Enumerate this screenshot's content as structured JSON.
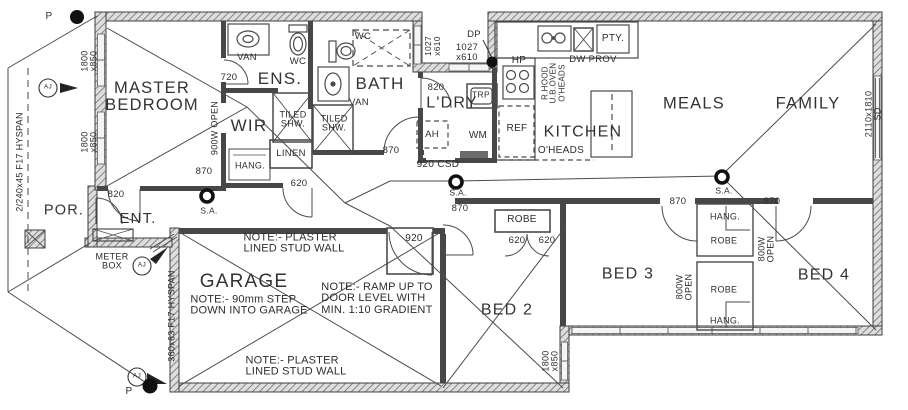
{
  "drawing": {
    "type": "residential floor plan",
    "title": "house floor plan"
  },
  "colors": {
    "wall": "#3f3f3f",
    "interior_wall": "#474747",
    "line": "#4b4b4b",
    "hatch_bg": "#dedede",
    "window": "#f2f2f2",
    "text": "#2d2d2d",
    "paper": "#ffffff"
  },
  "labels": [
    {
      "name": "room-master-bedroom",
      "cat": "room",
      "text": "MASTER\nBEDROOM",
      "x": 152,
      "y": 97,
      "fs": 16.5,
      "cls": "room"
    },
    {
      "name": "room-ens",
      "cat": "room",
      "text": "ENS.",
      "x": 280,
      "y": 79,
      "fs": 17,
      "cls": "room"
    },
    {
      "name": "room-wir",
      "cat": "room",
      "text": "WIR",
      "x": 249,
      "y": 126,
      "fs": 17,
      "cls": "room"
    },
    {
      "name": "room-bath",
      "cat": "room",
      "text": "BATH",
      "x": 380,
      "y": 84,
      "fs": 17,
      "cls": "room"
    },
    {
      "name": "room-ldry",
      "cat": "room",
      "text": "L'DRY",
      "x": 452,
      "y": 104,
      "fs": 16,
      "cls": "room"
    },
    {
      "name": "room-kitchen",
      "cat": "room",
      "text": "KITCHEN",
      "x": 583,
      "y": 133,
      "fs": 16,
      "cls": "room"
    },
    {
      "name": "room-meals",
      "cat": "room",
      "text": "MEALS",
      "x": 694,
      "y": 104,
      "fs": 16.5,
      "cls": "room"
    },
    {
      "name": "room-family",
      "cat": "room",
      "text": "FAMILY",
      "x": 808,
      "y": 104,
      "fs": 16.5,
      "cls": "room"
    },
    {
      "name": "room-por",
      "cat": "room",
      "text": "POR.",
      "x": 64,
      "y": 211,
      "fs": 14.5,
      "cls": "room"
    },
    {
      "name": "room-ent",
      "cat": "room",
      "text": "ENT.",
      "x": 138,
      "y": 219,
      "fs": 15,
      "cls": "room"
    },
    {
      "name": "room-garage",
      "cat": "room",
      "text": "GARAGE",
      "x": 244,
      "y": 282,
      "fs": 19,
      "cls": "room"
    },
    {
      "name": "room-bed2",
      "cat": "room",
      "text": "BED 2",
      "x": 507,
      "y": 311,
      "fs": 16,
      "cls": "room"
    },
    {
      "name": "room-bed3",
      "cat": "room",
      "text": "BED 3",
      "x": 628,
      "y": 275,
      "fs": 16,
      "cls": "room"
    },
    {
      "name": "room-bed4",
      "cat": "room",
      "text": "BED 4",
      "x": 824,
      "y": 276,
      "fs": 16,
      "cls": "room"
    },
    {
      "name": "fixture-van-ens",
      "cat": "fixture",
      "text": "VAN",
      "x": 247,
      "y": 58,
      "fs": 9.5
    },
    {
      "name": "fixture-wc-ens",
      "cat": "fixture",
      "text": "WC",
      "x": 298,
      "y": 62,
      "fs": 9.5
    },
    {
      "name": "fixture-wc-bath",
      "cat": "fixture",
      "text": "WC",
      "x": 363,
      "y": 37,
      "fs": 9.5
    },
    {
      "name": "fixture-van-bath",
      "cat": "fixture",
      "text": "VAN",
      "x": 359,
      "y": 103,
      "fs": 9.5
    },
    {
      "name": "fixture-tiled-shw-ens",
      "cat": "fixture",
      "text": "TILED\nSHW.",
      "x": 293,
      "y": 120,
      "fs": 9
    },
    {
      "name": "fixture-tiled-shw-bath",
      "cat": "fixture",
      "text": "TILED\nSHW.",
      "x": 334,
      "y": 124,
      "fs": 9
    },
    {
      "name": "fixture-linen",
      "cat": "fixture",
      "text": "LINEN",
      "x": 291,
      "y": 154,
      "fs": 9.5
    },
    {
      "name": "fixture-hang-wir",
      "cat": "fixture",
      "text": "HANG.",
      "x": 250,
      "y": 166,
      "fs": 9
    },
    {
      "name": "fixture-trough",
      "cat": "fixture",
      "text": "TRP",
      "x": 481,
      "y": 95,
      "fs": 8.5
    },
    {
      "name": "fixture-ah",
      "cat": "fixture",
      "text": "AH",
      "x": 432,
      "y": 135,
      "fs": 9.5
    },
    {
      "name": "fixture-wm",
      "cat": "fixture",
      "text": "WM",
      "x": 478,
      "y": 136,
      "fs": 10
    },
    {
      "name": "fixture-ref",
      "cat": "fixture",
      "text": "REF",
      "x": 517,
      "y": 129,
      "fs": 10
    },
    {
      "name": "fixture-hp",
      "cat": "fixture",
      "text": "HP",
      "x": 519,
      "y": 61,
      "fs": 10
    },
    {
      "name": "fixture-rangehood",
      "cat": "fixture",
      "text": "R.HOOD\nU.B.OVEN\nO'HEADS",
      "x": 554,
      "y": 83,
      "fs": 8,
      "rot": true
    },
    {
      "name": "fixture-dw-prov",
      "cat": "fixture",
      "text": "DW PROV",
      "x": 593,
      "y": 60,
      "fs": 9.5
    },
    {
      "name": "fixture-pty",
      "cat": "fixture",
      "text": "PTY.",
      "x": 613,
      "y": 39,
      "fs": 10
    },
    {
      "name": "fixture-oheads-kitchen",
      "cat": "fixture",
      "text": "O'HEADS",
      "x": 561,
      "y": 151,
      "fs": 10
    },
    {
      "name": "fixture-meter-box",
      "cat": "fixture",
      "text": "METER\nBOX",
      "x": 112,
      "y": 262,
      "fs": 9
    },
    {
      "name": "fixture-robe-hall",
      "cat": "fixture",
      "text": "ROBE",
      "x": 522,
      "y": 220,
      "fs": 10
    },
    {
      "name": "fixture-hang-robe-top",
      "cat": "fixture",
      "text": "HANG.",
      "x": 725,
      "y": 217,
      "fs": 9
    },
    {
      "name": "fixture-robe-top",
      "cat": "fixture",
      "text": "ROBE",
      "x": 724,
      "y": 241,
      "fs": 9
    },
    {
      "name": "fixture-robe-bottom",
      "cat": "fixture",
      "text": "ROBE",
      "x": 724,
      "y": 290,
      "fs": 9
    },
    {
      "name": "fixture-hang-robe-bottom",
      "cat": "fixture",
      "text": "HANG.",
      "x": 725,
      "y": 321,
      "fs": 9
    },
    {
      "name": "dim-720-ens-door",
      "cat": "dimension",
      "text": "720",
      "x": 229,
      "y": 78,
      "fs": 9.5
    },
    {
      "name": "dim-820-master-door",
      "cat": "dimension",
      "text": "820",
      "x": 116,
      "y": 195,
      "fs": 9.5
    },
    {
      "name": "dim-870-wir-door",
      "cat": "dimension",
      "text": "870",
      "x": 204,
      "y": 172,
      "fs": 9.5
    },
    {
      "name": "dim-900w-open",
      "cat": "dimension",
      "text": "900W OPEN",
      "x": 215,
      "y": 128,
      "fs": 9,
      "rot": true
    },
    {
      "name": "dim-window-1800x850-upper",
      "cat": "dimension",
      "text": "1800\nx850",
      "x": 90,
      "y": 61,
      "fs": 9,
      "rot": true
    },
    {
      "name": "dim-window-1800x850-lower",
      "cat": "dimension",
      "text": "1800\nx850",
      "x": 90,
      "y": 142,
      "fs": 9,
      "rot": true
    },
    {
      "name": "dim-beam-hyspan-porch",
      "cat": "dimension",
      "text": "2/240x45 F17 HYSPAN",
      "x": 20,
      "y": 162,
      "fs": 9,
      "rot": true
    },
    {
      "name": "dim-870-bath-door",
      "cat": "dimension",
      "text": "870",
      "x": 391,
      "y": 151,
      "fs": 9.5
    },
    {
      "name": "dim-620-linen-door",
      "cat": "dimension",
      "text": "620",
      "x": 299,
      "y": 184,
      "fs": 9.5
    },
    {
      "name": "dim-820-ldry-door",
      "cat": "dimension",
      "text": "820",
      "x": 436,
      "y": 88,
      "fs": 9.5
    },
    {
      "name": "dim-window-1027x610-vert",
      "cat": "dimension",
      "text": "1027\nx610",
      "x": 433,
      "y": 46,
      "fs": 8.5,
      "rot": true
    },
    {
      "name": "dim-window-1027x610-horiz",
      "cat": "dimension",
      "text": "1027\nx610",
      "x": 467,
      "y": 53,
      "fs": 9.5
    },
    {
      "name": "marker-dp",
      "cat": "marker",
      "text": "DP",
      "x": 474,
      "y": 35,
      "fs": 9.5
    },
    {
      "name": "dim-920-csd",
      "cat": "dimension",
      "text": "920 CSD",
      "x": 438,
      "y": 165,
      "fs": 10
    },
    {
      "name": "marker-sa-hall-left",
      "cat": "marker",
      "text": "S.A.",
      "x": 209,
      "y": 211,
      "fs": 8.5
    },
    {
      "name": "marker-sa-hall-mid",
      "cat": "marker",
      "text": "S.A.",
      "x": 458,
      "y": 193,
      "fs": 8.5
    },
    {
      "name": "marker-sa-living",
      "cat": "marker",
      "text": "S.A.",
      "x": 724,
      "y": 191,
      "fs": 8.5
    },
    {
      "name": "dim-870-hall-door",
      "cat": "dimension",
      "text": "870",
      "x": 460,
      "y": 209,
      "fs": 9.5
    },
    {
      "name": "dim-870-bed3-door",
      "cat": "dimension",
      "text": "870",
      "x": 678,
      "y": 202,
      "fs": 9.5
    },
    {
      "name": "dim-870-bed4-door",
      "cat": "dimension",
      "text": "870",
      "x": 772,
      "y": 202,
      "fs": 9.5
    },
    {
      "name": "dim-620-robe-left",
      "cat": "dimension",
      "text": "620",
      "x": 517,
      "y": 241,
      "fs": 9.5
    },
    {
      "name": "dim-620-robe-right",
      "cat": "dimension",
      "text": "620",
      "x": 547,
      "y": 241,
      "fs": 9.5
    },
    {
      "name": "dim-800w-open-right",
      "cat": "dimension",
      "text": "800W\nOPEN",
      "x": 767,
      "y": 249,
      "fs": 9,
      "rot": true
    },
    {
      "name": "dim-800w-open-left",
      "cat": "dimension",
      "text": "800W\nOPEN",
      "x": 685,
      "y": 287,
      "fs": 9,
      "rot": true
    },
    {
      "name": "dim-920-garage-door",
      "cat": "dimension",
      "text": "920",
      "x": 414,
      "y": 239,
      "fs": 10
    },
    {
      "name": "dim-window-1800x850-bed2",
      "cat": "dimension",
      "text": "1800\nx850",
      "x": 551,
      "y": 361,
      "fs": 9,
      "rot": true
    },
    {
      "name": "dim-sliding-door-2110x1810",
      "cat": "dimension",
      "text": "2110x1810 SD",
      "x": 874,
      "y": 114,
      "fs": 9,
      "rot": true
    },
    {
      "name": "dim-beam-hyspan-garage",
      "cat": "dimension",
      "text": "360x63 F17 HYSPAN",
      "x": 172,
      "y": 316,
      "fs": 9,
      "rot": true
    },
    {
      "name": "marker-p-top",
      "cat": "marker",
      "text": "P",
      "x": 49,
      "y": 17,
      "fs": 10
    },
    {
      "name": "marker-p-bottom",
      "cat": "marker",
      "text": "P",
      "x": 129,
      "y": 392,
      "fs": 10
    },
    {
      "name": "marker-aj-porch",
      "cat": "marker",
      "text": "AJ",
      "x": 48,
      "y": 88,
      "fs": 6.5
    },
    {
      "name": "marker-aj-entry",
      "cat": "marker",
      "text": "AJ",
      "x": 142,
      "y": 266,
      "fs": 6.5
    },
    {
      "name": "marker-aj-garage",
      "cat": "marker",
      "text": "AJ",
      "x": 137,
      "y": 377,
      "fs": 6.5
    },
    {
      "name": "note-plaster-top",
      "cat": "note",
      "text": "NOTE:- PLASTER\nLINED STUD WALL",
      "x": 294,
      "y": 244,
      "fs": 11,
      "cls": "note"
    },
    {
      "name": "note-step-down",
      "cat": "note",
      "text": "NOTE:- 90mm STEP\nDOWN INTO GARAGE",
      "x": 249,
      "y": 306,
      "fs": 11,
      "cls": "note"
    },
    {
      "name": "note-ramp",
      "cat": "note",
      "text": "NOTE:- RAMP UP TO\nDOOR LEVEL WITH\nMIN. 1:10 GRADIENT",
      "x": 377,
      "y": 299,
      "fs": 11,
      "cls": "note"
    },
    {
      "name": "note-plaster-bottom",
      "cat": "note",
      "text": "NOTE:- PLASTER\nLINED STUD WALL",
      "x": 296,
      "y": 367,
      "fs": 11,
      "cls": "note"
    }
  ]
}
